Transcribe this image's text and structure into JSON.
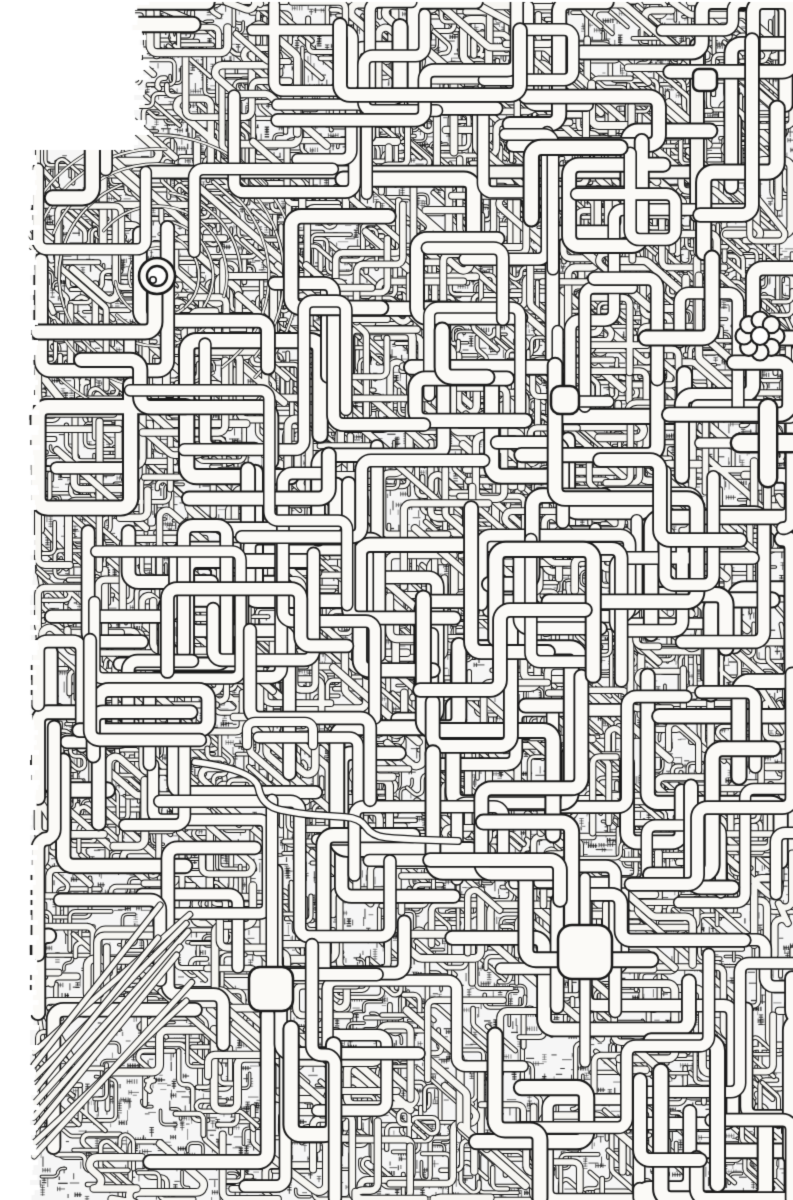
{
  "artwork": {
    "kind": "scanned black-ink line drawing",
    "subject": "extremely dense abstract maze of interlocking orthogonal pipes and circuit-like tubing covering the whole sheet",
    "canvas": {
      "width": 793,
      "height": 1200
    },
    "palette": {
      "paper": "#ffffff",
      "ink": "#1a1a1a",
      "pipe_fill": "#f7f6f2",
      "node_fill": "#fbfaf7",
      "wash": "rgba(70,70,70,0.05)"
    },
    "texture": {
      "seed": 1337,
      "counts": {
        "hatch": 12000,
        "micro_pipes": 700,
        "small_pipes": 1400,
        "medium_pipes": 480,
        "large_pipes": 170
      },
      "bands": [
        {
          "y_max": 540,
          "density": 0.95
        },
        {
          "y_max": 900,
          "density": 0.85
        },
        {
          "y_max": 1200,
          "density": 0.62
        }
      ],
      "dark_patch": {
        "x0": 300,
        "x1": 650,
        "y0": 380,
        "y1": 560,
        "boost": 0.08
      },
      "margins": {
        "left": 34,
        "corner_w": 140,
        "corner_h": 150
      }
    },
    "landmarks": {
      "concentric_hub": {
        "x": 157,
        "y": 276,
        "ring_radii": [
          28,
          42,
          56,
          70,
          84,
          98,
          112,
          127,
          141
        ],
        "core_radius": 18,
        "inner_radius": 10
      },
      "hub_elbow_pipe": {
        "points": [
          [
            155,
            294
          ],
          [
            155,
            332
          ],
          [
            38,
            332
          ]
        ],
        "width": 13
      },
      "rosette": {
        "x": 760,
        "y": 336,
        "petal_count": 8,
        "petal_radius": 8.5,
        "orbit_radius": 16,
        "center_radius": 9
      },
      "rosette_feed_pipe": {
        "points": [
          [
            712,
            258
          ],
          [
            712,
            338
          ],
          [
            646,
            338
          ]
        ],
        "width": 13
      },
      "rosette_out_pipe": {
        "points": [
          [
            745,
            338
          ],
          [
            792,
            338
          ]
        ],
        "width": 13
      },
      "chip_large": {
        "x": 585,
        "y": 952,
        "size": 54,
        "corner_radius": 14,
        "stub_down": [
          [
            585,
            979
          ],
          [
            585,
            1062
          ]
        ],
        "stub_up": [
          [
            585,
            925
          ],
          [
            585,
            878
          ]
        ],
        "stub_width": 9
      },
      "chip_small": {
        "x": 271,
        "y": 989,
        "size": 44,
        "corner_radius": 11,
        "stub_up": [
          [
            272,
            967
          ],
          [
            272,
            800
          ]
        ],
        "stub_width": 10
      },
      "white_blob": {
        "x": 565,
        "y": 400,
        "size": 28,
        "corner_radius": 9
      },
      "cross_junction": {
        "h": [
          [
            740,
            443
          ],
          [
            792,
            443
          ]
        ],
        "v": [
          [
            768,
            408
          ],
          [
            768,
            478
          ]
        ],
        "width": 16,
        "feed": [
          [
            700,
            443
          ],
          [
            740,
            443
          ]
        ],
        "feed_width": 9
      },
      "mini_node": {
        "x": 705,
        "y": 80,
        "w": 24,
        "h": 22,
        "corner_radius": 6
      },
      "long_horizontal_pipe": {
        "points": [
          [
            150,
            172
          ],
          [
            735,
            172
          ],
          [
            735,
            120
          ]
        ],
        "width": 11
      },
      "right_vertical_pipe": {
        "points": [
          [
            697,
            45
          ],
          [
            697,
            215
          ]
        ],
        "width": 12
      },
      "s_curve_cable": {
        "points": [
          [
            195,
            762
          ],
          [
            255,
            770
          ],
          [
            262,
            806
          ],
          [
            300,
            814
          ],
          [
            330,
            816
          ],
          [
            360,
            818
          ],
          [
            372,
            836
          ],
          [
            400,
            839
          ],
          [
            458,
            841
          ]
        ],
        "width": 5.5
      },
      "diagonal_bundle": {
        "x": 34,
        "y_start": 1052,
        "y_step": 13,
        "len_x": 120,
        "len_y": -135,
        "count": 9,
        "width": 5
      },
      "accent_pipes": [
        {
          "points": [
            [
              340,
              25
            ],
            [
              340,
              95
            ],
            [
              520,
              95
            ],
            [
              520,
              30
            ]
          ],
          "width": 12
        },
        {
          "points": [
            [
              752,
              40
            ],
            [
              752,
              215
            ],
            [
              700,
              215
            ]
          ],
          "width": 12
        },
        {
          "points": [
            [
              600,
              460
            ],
            [
              660,
              460
            ],
            [
              660,
              540
            ],
            [
              740,
              540
            ]
          ],
          "width": 12
        },
        {
          "points": [
            [
              90,
              640
            ],
            [
              90,
              740
            ],
            [
              200,
              740
            ]
          ],
          "width": 11
        },
        {
          "points": [
            [
              250,
              630
            ],
            [
              250,
              718
            ],
            [
              370,
              718
            ],
            [
              370,
              800
            ]
          ],
          "width": 11
        },
        {
          "points": [
            [
              430,
              860
            ],
            [
              560,
              860
            ],
            [
              560,
              900
            ]
          ],
          "width": 12
        },
        {
          "points": [
            [
              60,
              900
            ],
            [
              160,
              900
            ],
            [
              160,
              980
            ]
          ],
          "width": 11
        },
        {
          "points": [
            [
              640,
              1080
            ],
            [
              640,
              1160
            ],
            [
              700,
              1160
            ]
          ],
          "width": 12
        },
        {
          "points": [
            [
              420,
              690
            ],
            [
              500,
              690
            ],
            [
              500,
              610
            ],
            [
              585,
              610
            ]
          ],
          "width": 12
        },
        {
          "points": [
            [
              312,
              945
            ],
            [
              312,
              1055
            ],
            [
              335,
              1055
            ],
            [
              335,
              1198
            ]
          ],
          "width": 11
        },
        {
          "points": [
            [
              495,
              1035
            ],
            [
              495,
              1130
            ],
            [
              540,
              1130
            ],
            [
              540,
              1198
            ]
          ],
          "width": 13
        },
        {
          "points": [
            [
              247,
              745
            ],
            [
              247,
              722
            ],
            [
              313,
              722
            ],
            [
              313,
              745
            ]
          ],
          "width": 8
        }
      ]
    }
  }
}
